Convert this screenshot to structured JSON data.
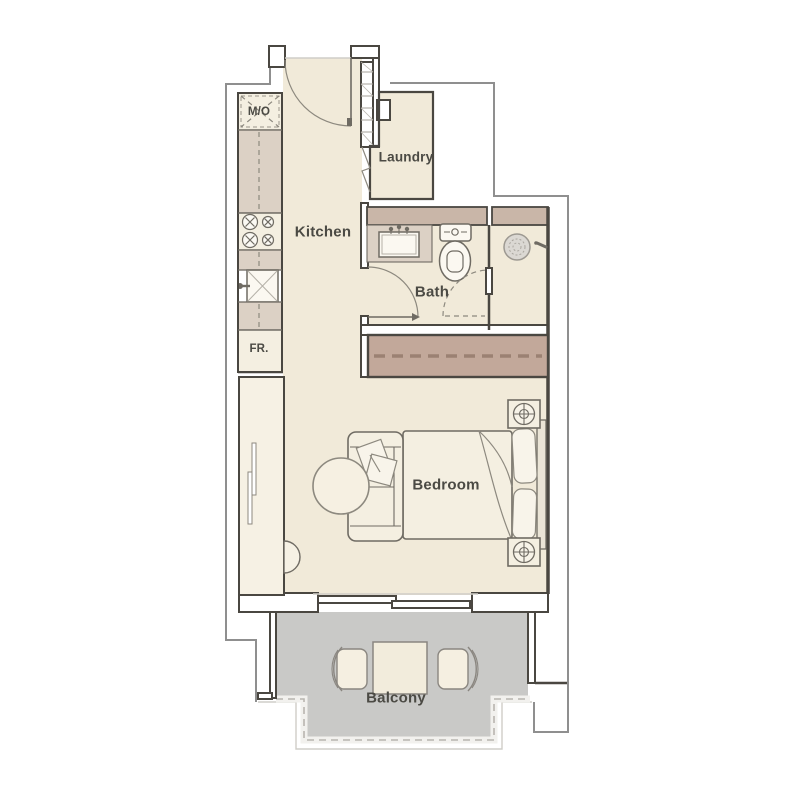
{
  "floor_plan": {
    "title": "Studio apartment floor plan",
    "rooms": {
      "kitchen": {
        "label": "Kitchen"
      },
      "laundry": {
        "label": "Laundry"
      },
      "bath": {
        "label": "Bath"
      },
      "bedroom": {
        "label": "Bedroom"
      },
      "balcony": {
        "label": "Balcony"
      }
    },
    "appliances": {
      "microwave_oven": {
        "label": "M/O"
      },
      "fridge": {
        "label": "FR."
      }
    },
    "icons": [
      "entry-door-icon",
      "stove-burners-icon",
      "kitchen-sink-icon",
      "fridge-icon",
      "vanity-sink-icon",
      "toilet-icon",
      "shower-drain-icon",
      "shower-handle-icon",
      "bed-icon",
      "pillow-icon",
      "nightstand-lamp-icon",
      "sofa-icon",
      "round-table-icon",
      "sliding-wardrobe-icon",
      "closet-sliding-door-icon",
      "balcony-table-icon",
      "balcony-chair-icon",
      "sliding-glass-door-icon",
      "shaft-hatch-icon"
    ],
    "colors": {
      "floor": "#f1ead9",
      "cabinet": "#f4efe1",
      "counter": "#dcd1c5",
      "closet": "#f6f1e4",
      "wallband": "#c9b6a8",
      "wardrobe": "#c2a89a",
      "wardrobe_dash": "#9b8173",
      "balcony": "#c9c9c7",
      "wall_dark": "#4a4741",
      "stroke_medium": "#6f6b63",
      "sketch": "#8d897f",
      "exterior_line": "#8f8f8f",
      "text": "#4b4a44"
    }
  }
}
